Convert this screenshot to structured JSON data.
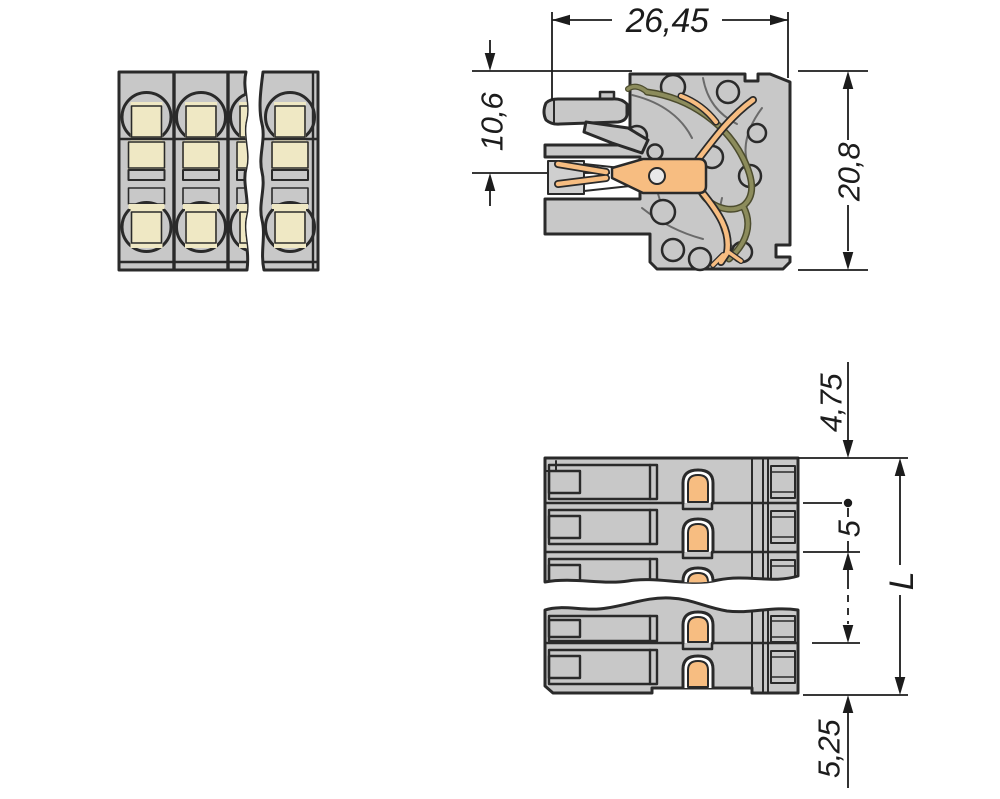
{
  "views": {
    "front": {
      "poles_visible": 4
    },
    "section": {
      "dims": {
        "width": "26,45",
        "clamp_axis_height": "10,6",
        "total_height": "20,8"
      }
    },
    "top": {
      "dims": {
        "top_offset": "4,75",
        "pitch": "5",
        "length": "L",
        "bottom_offset": "5,25"
      }
    }
  },
  "colors": {
    "housing": "#c8c8c8",
    "insert_yellow": "#ffd400",
    "insert_pale": "#efe8c4",
    "contact_copper": "#f7bd81",
    "spring_olive": "#8c8c5c",
    "line": "#2a2a2a",
    "dimension_ink": "#1c1c1c",
    "background": "#ffffff"
  }
}
